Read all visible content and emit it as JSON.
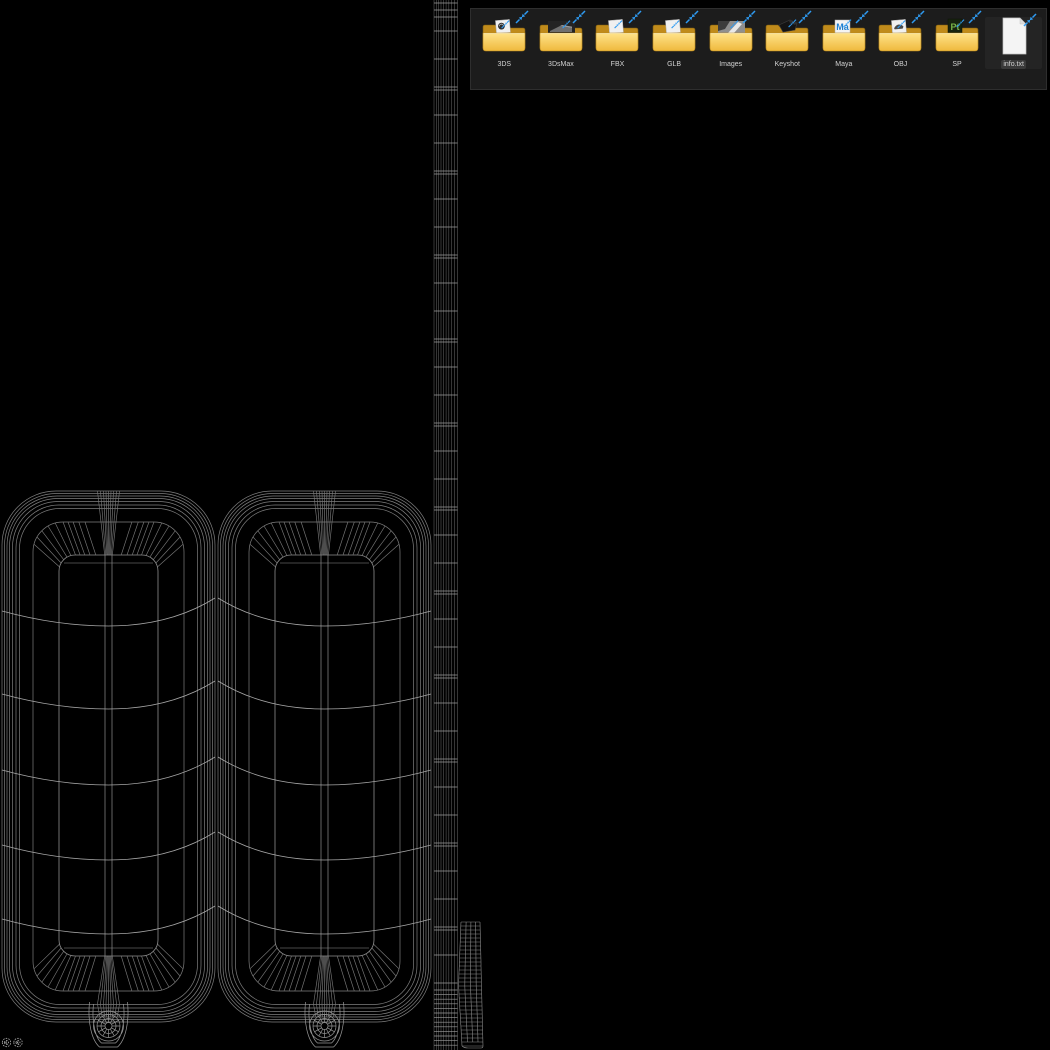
{
  "desktop": {
    "background_color": "#000000"
  },
  "viewport": {
    "model_name": "luggage-suitcase-wireframe",
    "colors": {
      "rim": "#7f7f7f",
      "face": "#8e8e8e",
      "fan": "#787878",
      "belt": "#a6a6a6",
      "strip_vertical": "#5a5a5a",
      "strip_horizontal": "#9c9c9c",
      "small_strip": "#8a8a8a",
      "wheel": "#969696",
      "hub": "#b0b0b0"
    }
  },
  "file_panel": {
    "background": "#1c1c1c",
    "border": "#2e2e2e",
    "accent_blue": "#2f9bf2",
    "folder_front_top": "#ffe38a",
    "folder_front_bottom": "#efb93d",
    "folder_back": "#c08b1b",
    "label_color": "#d2d2d2",
    "items": [
      {
        "label": "3DS",
        "icon": "folder",
        "preview": "page-disc",
        "selected": false
      },
      {
        "label": "3DsMax",
        "icon": "folder",
        "preview": "render-dark",
        "selected": false
      },
      {
        "label": "FBX",
        "icon": "folder",
        "preview": "page",
        "selected": false
      },
      {
        "label": "GLB",
        "icon": "folder",
        "preview": "page",
        "selected": false
      },
      {
        "label": "Images",
        "icon": "folder",
        "preview": "photo",
        "selected": false
      },
      {
        "label": "Keyshot",
        "icon": "folder",
        "preview": "shape-dark",
        "selected": false
      },
      {
        "label": "Maya",
        "icon": "folder",
        "preview": "maya-logo",
        "logo_text": "Ma",
        "logo_color": "#1e7fd0",
        "selected": false
      },
      {
        "label": "OBJ",
        "icon": "folder",
        "preview": "page-car",
        "selected": false
      },
      {
        "label": "SP",
        "icon": "folder",
        "preview": "painter-logo",
        "logo_text": "Pt",
        "logo_color": "#7ab648",
        "selected": false
      },
      {
        "label": "info.txt",
        "icon": "text-file",
        "preview": "none",
        "selected": true
      }
    ]
  }
}
